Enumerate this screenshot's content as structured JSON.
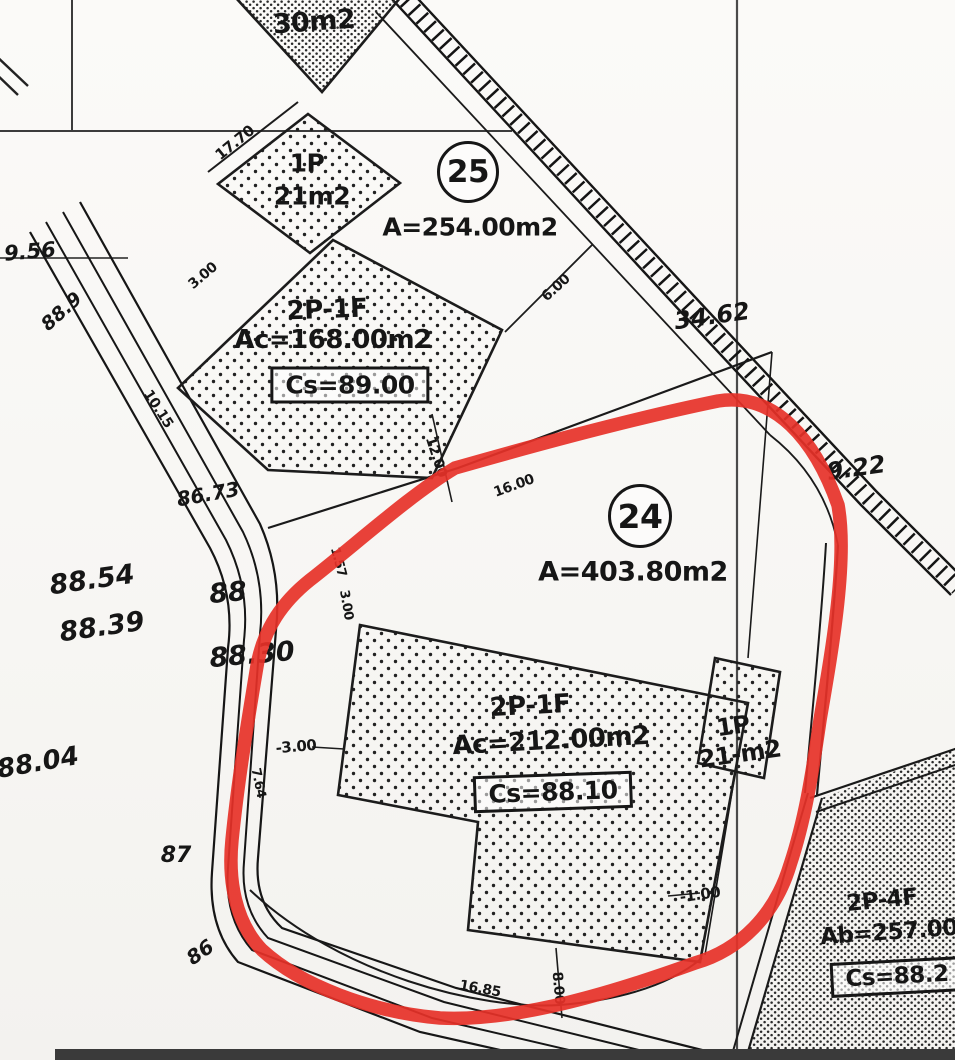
{
  "map_type": "cadastral-survey-plan",
  "colors": {
    "ink": "#1a1a1a",
    "paper": "#fbfaf8",
    "highlight": "#e63128",
    "grid": "#4a4a4a"
  },
  "ptop": {
    "area": "30m2"
  },
  "p25": {
    "number": "25",
    "area": "A=254.00m2",
    "small_building": {
      "floors": "1P",
      "area": "21m2"
    },
    "main_building": {
      "floors": "2P-1F",
      "area": "Ac=168.00m2",
      "height": "Cs=89.00"
    }
  },
  "p24": {
    "number": "24",
    "area": "A=403.80m2",
    "main_building": {
      "floors": "2P-1F",
      "area": "Ac=212.00m2",
      "height": "Cs=88.10"
    },
    "small_building": {
      "floors": "1P",
      "area": "21-m2"
    }
  },
  "pse": {
    "main_building": {
      "floors": "2P-4F",
      "area": "Ab=257.00",
      "height": "Cs=88.2"
    }
  },
  "dims": {
    "d17_70": "17.70",
    "d3_00a": "3.00",
    "d6_00": "6.00",
    "d10_15": "10.15",
    "d12_00": "12.00",
    "d16_00": "16.00",
    "d1_57": "1.57",
    "d3_00v": "3.00",
    "d3_00b": "-3.00",
    "d7_64": "7.64",
    "d1_00": "-1.00",
    "d16_85": "16.85",
    "d8_00": "8.00"
  },
  "spots": {
    "s9_56": "9.56",
    "s88_9": "88.9",
    "s86_73": "86.73",
    "s88_54": "88.54",
    "s88_39": "88.39",
    "s88": "88",
    "s88_30": "88.30",
    "s88_04": "88.04",
    "s87": "87",
    "s86": "86",
    "s34_62": "34.62",
    "s9_22": "9.22"
  }
}
